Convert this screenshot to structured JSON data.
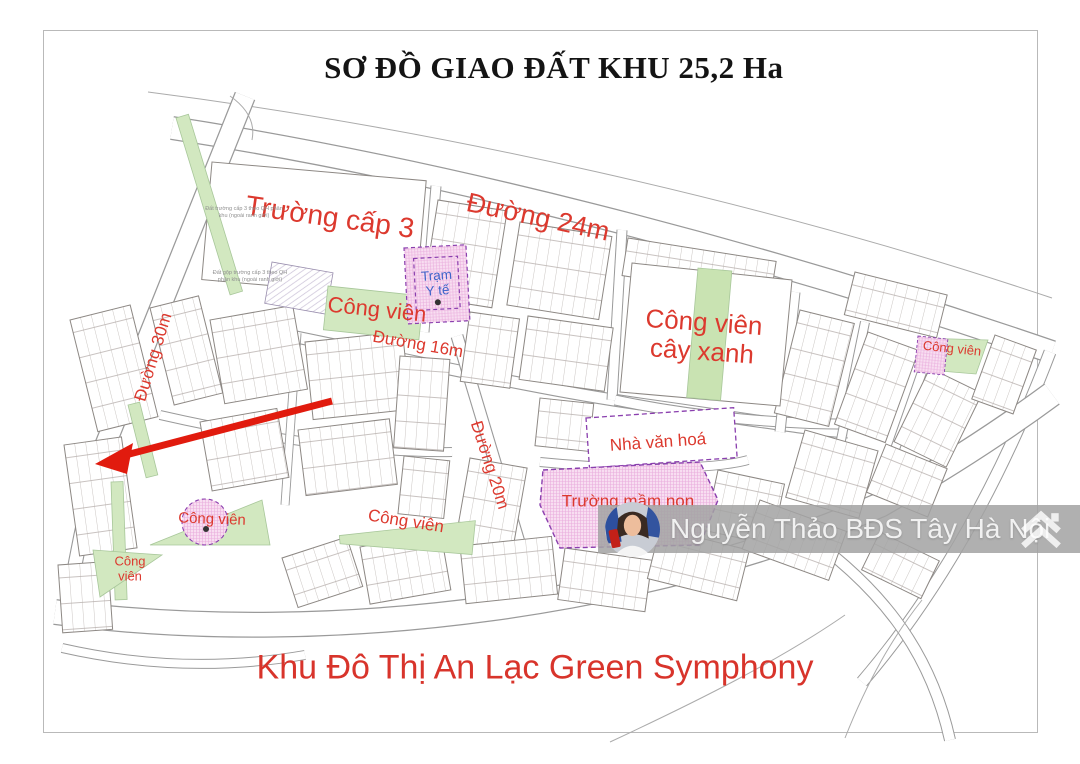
{
  "title": "SƠ ĐỒ GIAO ĐẤT KHU 25,2 Ha",
  "footer_title": "Khu Đô Thị An Lạc Green Symphony",
  "watermark": {
    "name": "Nguyễn Thảo BĐS Tây Hà Nội",
    "logo": "double-chevron-house-icon",
    "avatar": "agent-portrait-photo"
  },
  "map": {
    "labels": {
      "road_24m": "Đường 24m",
      "road_16m": "Đường 16m",
      "road_30m": "Đường 30m",
      "road_20m": "Đường 20m",
      "high_school": "Trường cấp 3",
      "park": "Công viên",
      "green_park_line1": "Công viên",
      "green_park_line2": "cây xanh",
      "culture_house": "Nhà văn hoá",
      "kindergarten": "Trường mầm non",
      "medical_line1": "Trạm",
      "medical_line2": "Y tế",
      "note_top": "Đất trường cấp 3 theo QH phân khu (ngoài ranh giới)",
      "note_bottom": "Đất gộp trường cấp 3 theo QH phân khu (ngoài ranh giới)"
    },
    "colors": {
      "label_red": "#dc392e",
      "park_green": "#d2e8c0",
      "hatch_pink": "#f8def1",
      "dashed_purple": "#8a3fae",
      "medical_blue": "#3f64c9",
      "road_line": "#9a9a9a",
      "arrow_red": "#e11b0e",
      "title_black": "#141414",
      "footer_red": "#d8342b"
    }
  }
}
